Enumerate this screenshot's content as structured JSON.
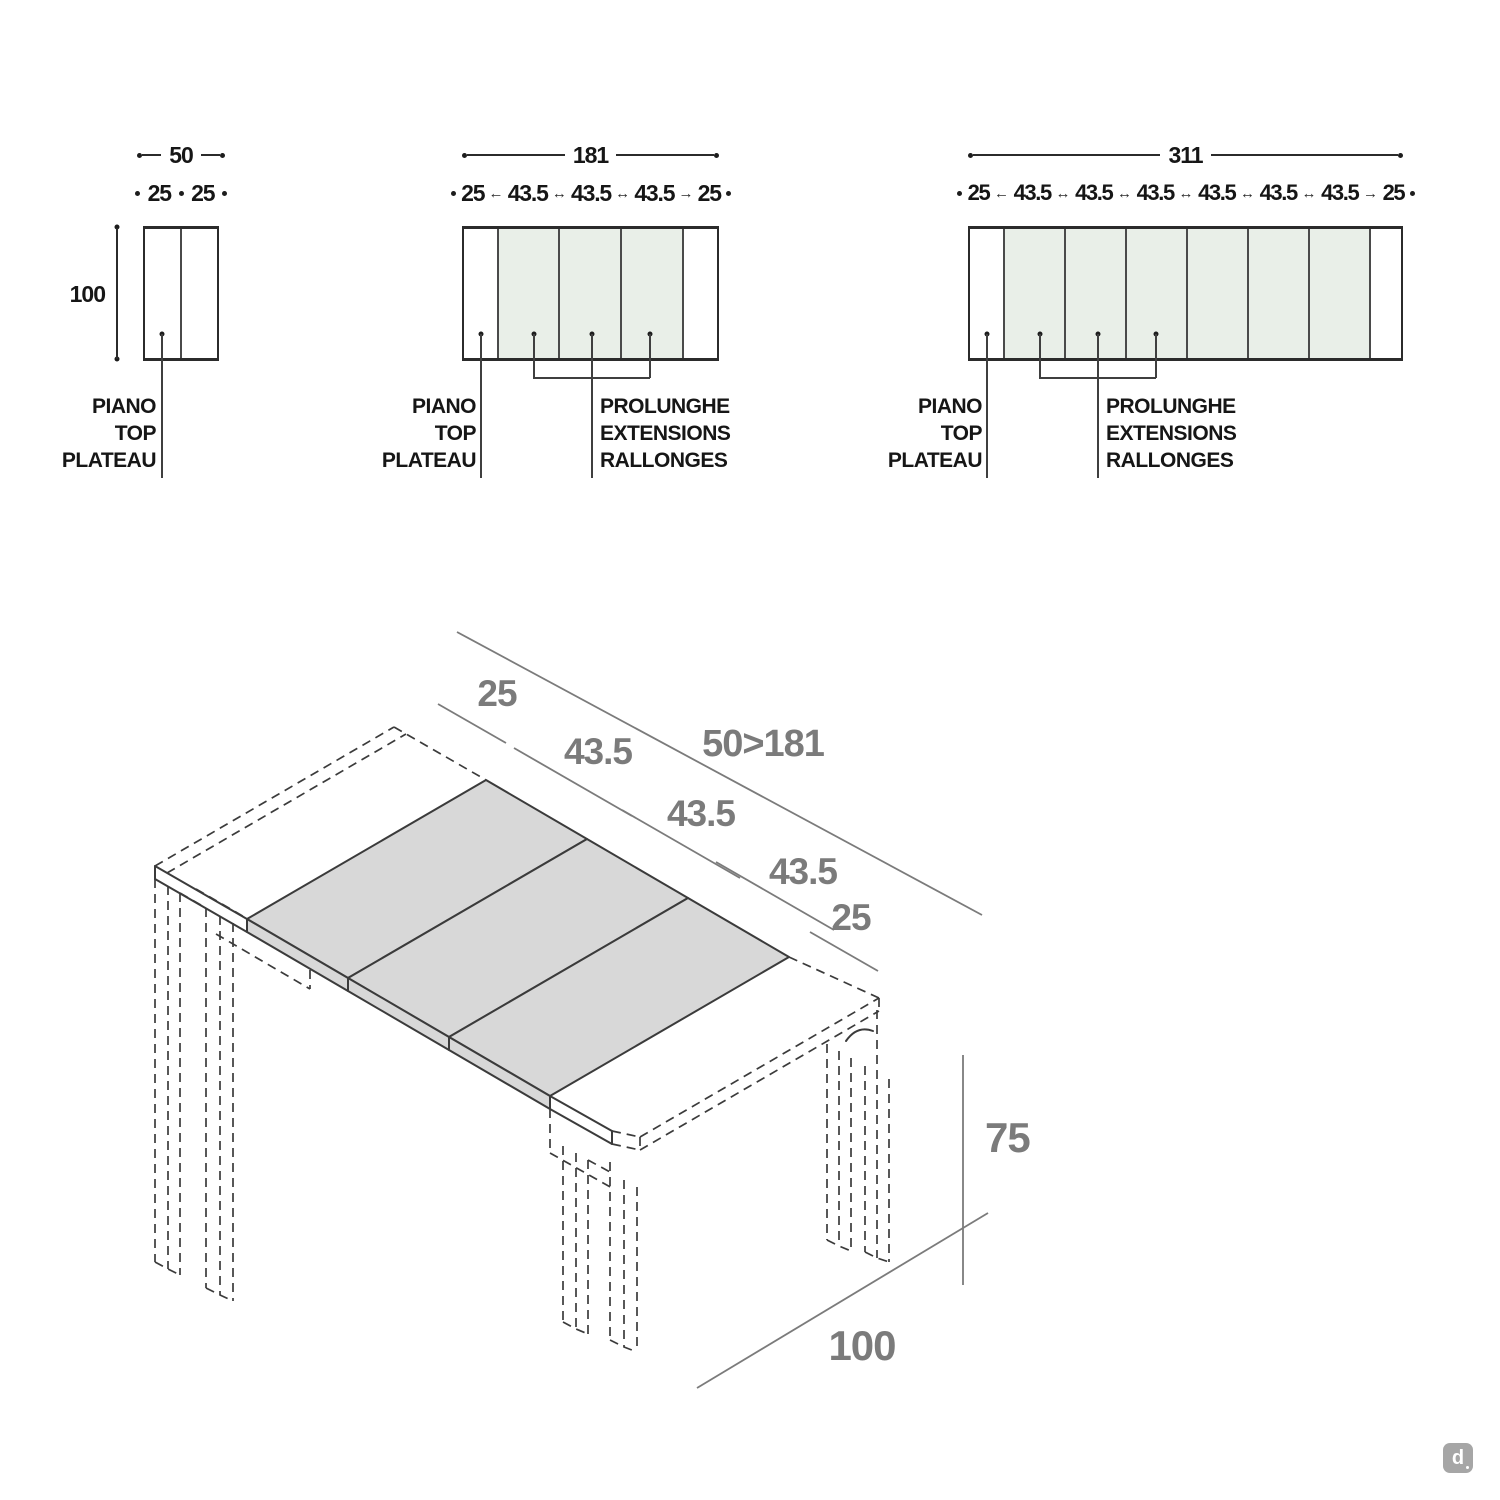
{
  "colors": {
    "extension_panel_green": "#e9efe8",
    "leaf_gray": "#d8d8d8",
    "line_dark": "#2b2b2b",
    "dim_gray": "#7b7b7b"
  },
  "glyphs": {
    "arrow_left": "←",
    "arrow_right": "→",
    "arrow_both": "↔"
  },
  "top_views": [
    {
      "total": "50",
      "chain": [
        "25",
        "25"
      ],
      "side": "100",
      "piano": [
        "PIANO",
        "TOP",
        "PLATEAU"
      ]
    },
    {
      "total": "181",
      "chain": [
        "25",
        "43.5",
        "43.5",
        "43.5",
        "25"
      ],
      "piano": [
        "PIANO",
        "TOP",
        "PLATEAU"
      ],
      "prolunghe": [
        "PROLUNGHE",
        "EXTENSIONS",
        "RALLONGES"
      ]
    },
    {
      "total": "311",
      "chain": [
        "25",
        "43.5",
        "43.5",
        "43.5",
        "43.5",
        "43.5",
        "43.5",
        "25"
      ],
      "piano": [
        "PIANO",
        "TOP",
        "PLATEAU"
      ],
      "prolunghe": [
        "PROLUNGHE",
        "EXTENSIONS",
        "RALLONGES"
      ]
    }
  ],
  "iso_view": {
    "segments": [
      "25",
      "43.5",
      "43.5",
      "43.5",
      "25"
    ],
    "extension_range": "50>181",
    "height": "75",
    "depth": "100"
  },
  "watermark": "d"
}
